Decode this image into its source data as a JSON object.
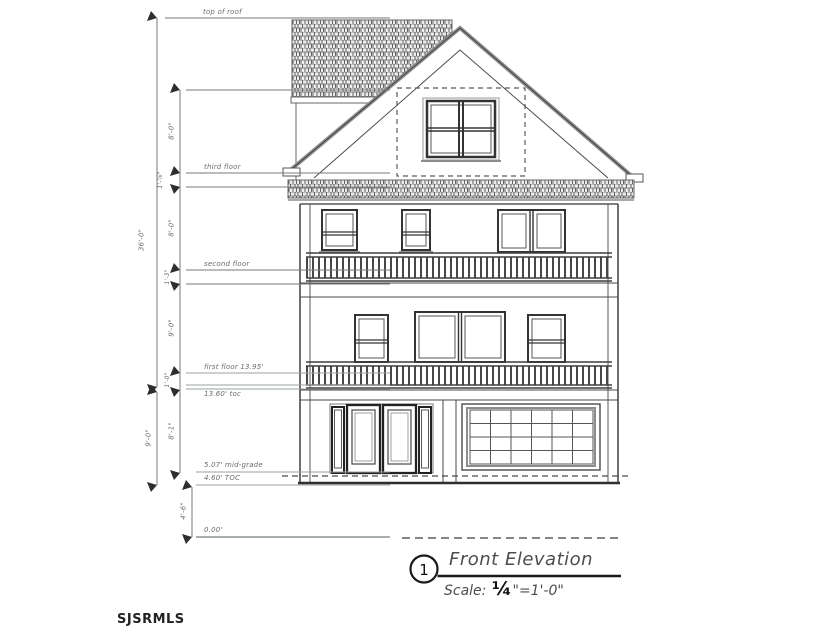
{
  "watermark": "SJSRMLS",
  "title_block": {
    "drawing_number": "1",
    "title": "Front Elevation",
    "scale_label": "Scale:",
    "scale_fraction": "¼",
    "scale_rest": "\"=1'-0\""
  },
  "level_labels": {
    "top_of_roof": "top of roof",
    "third_floor": "third floor",
    "second_floor": "second floor",
    "first_floor": "first floor 13.95'",
    "toc_upper": "13.60' toc",
    "mid_grade": "5.07' mid-grade",
    "toc_lower": "4.60' TOC",
    "datum": "0.00'"
  },
  "dimensions": {
    "overall_height": "36'-0\"",
    "attic_to_third": "8'-0\"",
    "third_floor_band": "1'-⅞\"",
    "third_to_second": "8'-0\"",
    "second_floor_band": "1'-3\"",
    "second_to_first": "9'-0\"",
    "first_floor_band": "1'-0\"",
    "first_to_grade": "8'-1\"",
    "toc_to_toc": "9'-0\"",
    "toc_to_datum": "4'-6\""
  }
}
